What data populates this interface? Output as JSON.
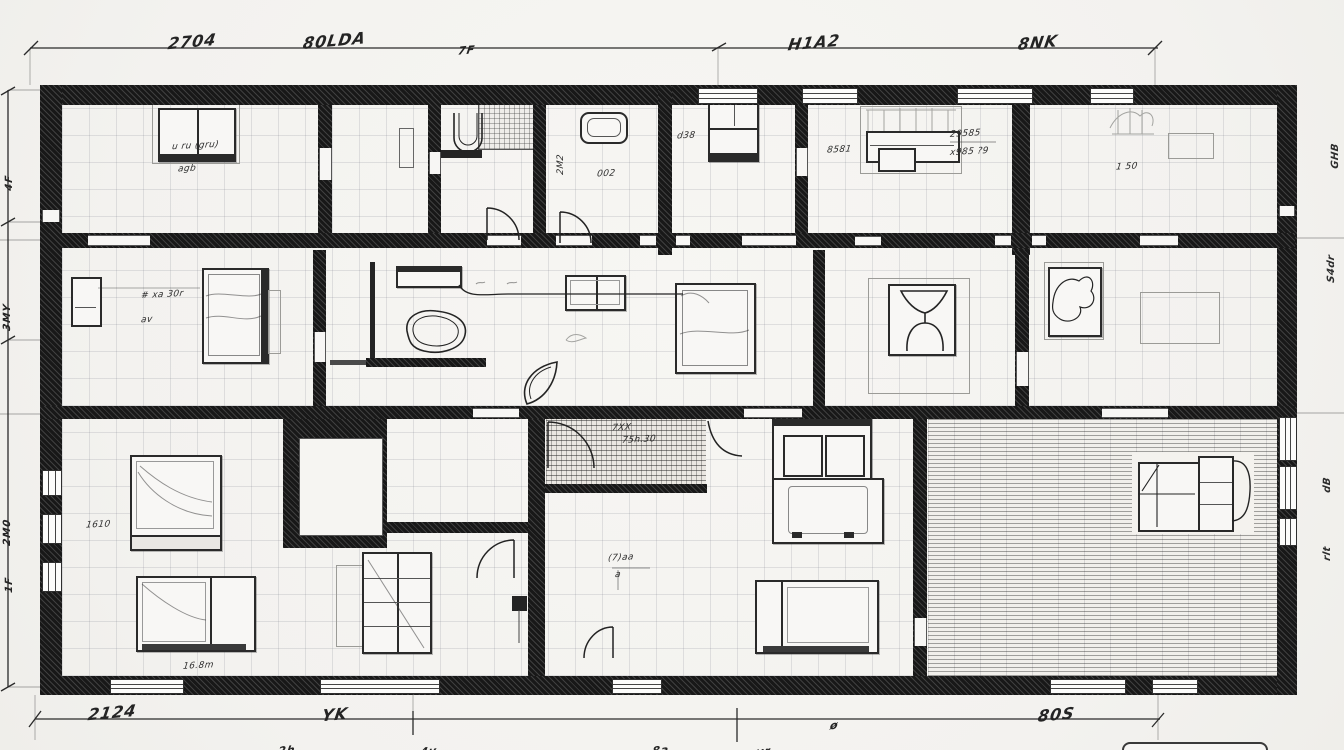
{
  "drawing": {
    "kind": "hand-sketched floor plan",
    "paper_color": "#f5f4f1",
    "ink_color": "#1f1f1f",
    "pencil_color": "#9a9a98",
    "grid_color": "rgba(115,118,132,0.18)"
  },
  "dims": {
    "top": {
      "d1": "2704",
      "d2": "80LDA",
      "d3": "7F",
      "d4": "H1A2",
      "d5": "8NK"
    },
    "bottom": {
      "d1": "2124",
      "d2": "YK",
      "d3": "ø",
      "d4": "80S"
    },
    "bottom2": {
      "d1": "2h",
      "d2": "4y",
      "d3": "8a",
      "d4": "yr"
    },
    "left": {
      "d1": "4F",
      "d2": "3MY",
      "d3": "2M0",
      "d4": "1F"
    },
    "right": {
      "d1": "GHB",
      "d2": "S4dr",
      "d3": "dB",
      "d4": "rlt"
    }
  },
  "notes": {
    "room_tl_1": "u ru (gru)",
    "room_tl_2": "agb",
    "bath_vertical": "2M2",
    "bath_small": "002",
    "closet_note": "d38",
    "study_left": "8581",
    "study_top": "29585",
    "study_right": "x985 ?9",
    "suite_note": "1 50",
    "bedroom_w_1": "# xa 30r",
    "bedroom_w_2": "av",
    "corridor_1": "7XX",
    "corridor_2": "75h.30",
    "hall_1": "(7)aa",
    "hall_2": "a",
    "bed_label": "1610",
    "area_label": "16.8m"
  }
}
